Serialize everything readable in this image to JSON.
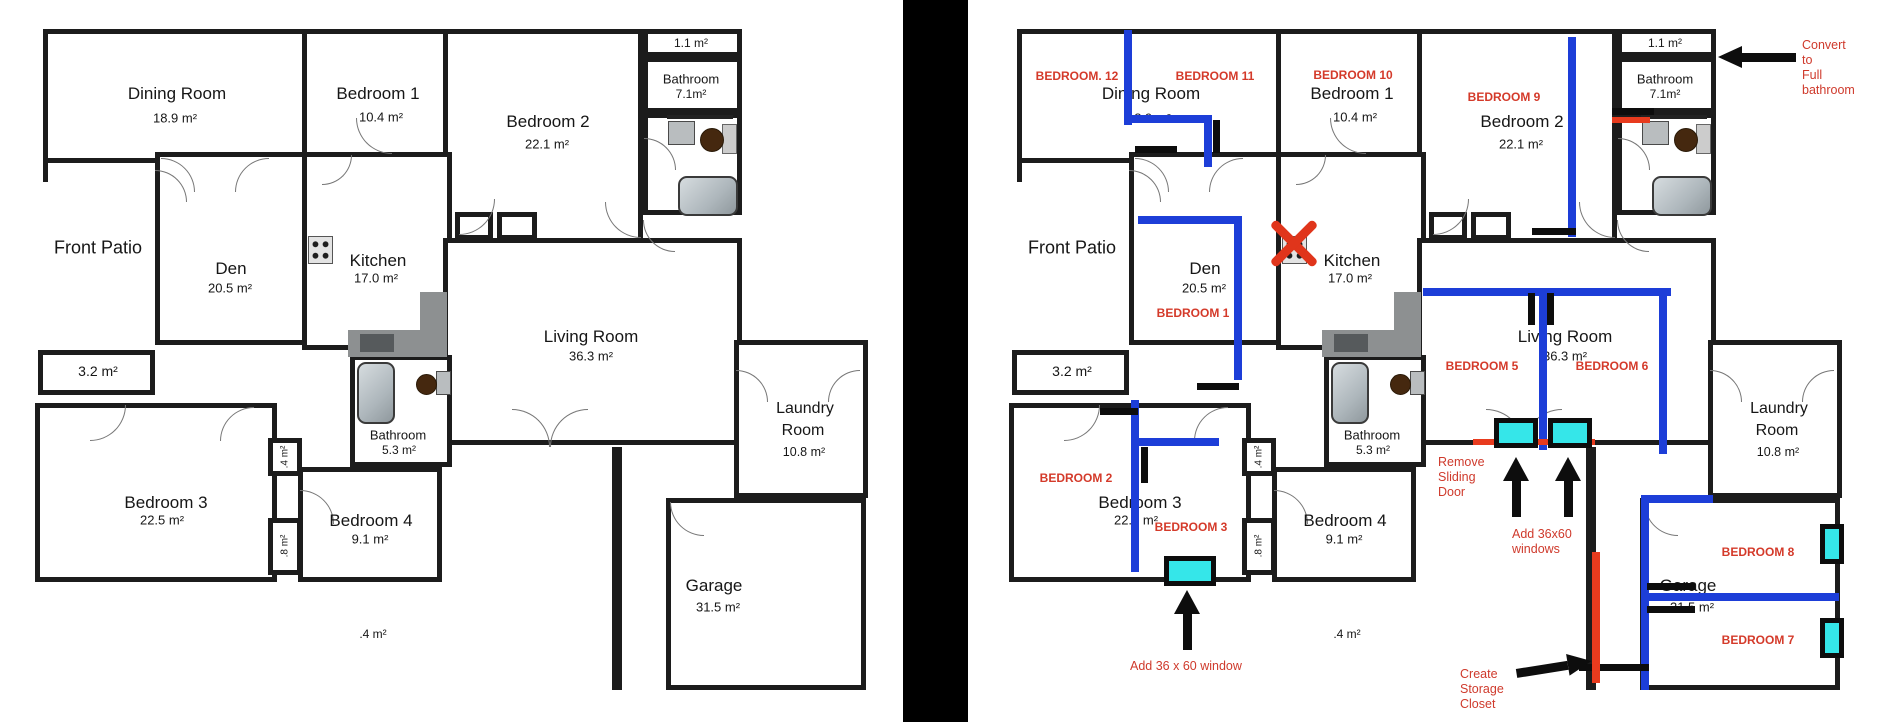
{
  "colors": {
    "wall": "#1c1c1c",
    "new_wall_blue": "#1d3ed8",
    "annotation_red": "#d43a2a",
    "remove_red": "#e83b1e",
    "window_cyan": "#35e6e9",
    "divider": "#000000"
  },
  "base_plan": {
    "rooms": [
      {
        "id": "dining-room",
        "name": "Dining Room",
        "area": "18.9 m²",
        "box": [
          13,
          11,
          267,
          134
        ],
        "nl": [
          147,
          76
        ],
        "al": [
          145,
          100
        ]
      },
      {
        "id": "bedroom-1",
        "name": "Bedroom 1",
        "area": "10.4 m²",
        "box": [
          272,
          11,
          150,
          134
        ],
        "nl": [
          348,
          76
        ],
        "al": [
          351,
          99
        ]
      },
      {
        "id": "bedroom-2",
        "name": "Bedroom 2",
        "area": "22.1 m²",
        "box": [
          413,
          11,
          200,
          218
        ],
        "nl": [
          518,
          104
        ],
        "al": [
          517,
          126
        ]
      },
      {
        "id": "closet-top",
        "name": "",
        "area": "1.1 m²",
        "box": [
          613,
          11,
          99,
          28
        ],
        "al": [
          661,
          25
        ],
        "cls": "sm"
      },
      {
        "id": "bathroom-top",
        "name": "Bathroom",
        "area": "7.1m²",
        "box": [
          613,
          39,
          99,
          56
        ],
        "nl": [
          661,
          61
        ],
        "al": [
          661,
          76
        ],
        "cls": "sm"
      },
      {
        "id": "bathroom-top-wc",
        "name": "",
        "area": "",
        "box": [
          613,
          95,
          99,
          102
        ]
      },
      {
        "id": "den",
        "name": "Den",
        "area": "20.5 m²",
        "box": [
          125,
          134,
          155,
          193
        ],
        "nl": [
          201,
          251
        ],
        "al": [
          200,
          270
        ]
      },
      {
        "id": "kitchen",
        "name": "Kitchen",
        "area": "17.0 m²",
        "box": [
          272,
          134,
          150,
          198
        ],
        "nl": [
          348,
          243
        ],
        "al": [
          346,
          260
        ]
      },
      {
        "id": "living-room",
        "name": "Living Room",
        "area": "36.3 m²",
        "box": [
          413,
          220,
          299,
          207
        ],
        "nl": [
          561,
          319
        ],
        "al": [
          561,
          338
        ]
      },
      {
        "id": "closet-32",
        "name": "",
        "area": "3.2 m²",
        "box": [
          8,
          332,
          117,
          45
        ],
        "al": [
          68,
          353
        ],
        "cls": "md"
      },
      {
        "id": "bedroom-3",
        "name": "Bedroom 3",
        "area": "22.5 m²",
        "box": [
          5,
          385,
          242,
          179
        ],
        "nl": [
          136,
          485
        ],
        "al": [
          132,
          502
        ]
      },
      {
        "id": "closet-4",
        "name": "",
        "area": ".4 m²",
        "box": [
          238,
          420,
          34,
          38
        ],
        "al": [
          255,
          439
        ],
        "cls": "xs",
        "vertical": true
      },
      {
        "id": "closet-8",
        "name": "",
        "area": ".8 m²",
        "box": [
          238,
          500,
          34,
          57
        ],
        "al": [
          255,
          528
        ],
        "cls": "xs",
        "vertical": true
      },
      {
        "id": "bedroom-4",
        "name": "Bedroom 4",
        "area": "9.1 m²",
        "box": [
          268,
          449,
          144,
          115
        ],
        "nl": [
          341,
          503
        ],
        "al": [
          340,
          521
        ]
      },
      {
        "id": "bathroom-53",
        "name": "Bathroom",
        "area": "5.3 m²",
        "box": [
          320,
          337,
          102,
          112
        ],
        "nl": [
          368,
          417
        ],
        "al": [
          369,
          432
        ],
        "cls": "sm"
      },
      {
        "id": "bedroom2-closet-a",
        "name": "",
        "area": "",
        "box": [
          425,
          194,
          38,
          28
        ]
      },
      {
        "id": "bedroom2-closet-b",
        "name": "",
        "area": "",
        "box": [
          467,
          194,
          40,
          28
        ]
      },
      {
        "id": "laundry-room",
        "name": "Laundry",
        "name2": "Room",
        "area": "10.8 m²",
        "box": [
          704,
          322,
          134,
          158
        ],
        "nl": [
          775,
          391
        ],
        "nl2": [
          773,
          413
        ],
        "al": [
          774,
          434
        ],
        "cls": "md2"
      },
      {
        "id": "garage",
        "name": "Garage",
        "area": "31.5 m²",
        "box": [
          636,
          480,
          200,
          192
        ],
        "nl": [
          684,
          568
        ],
        "al": [
          688,
          589
        ]
      }
    ],
    "extra_walls": [
      [
        582,
        429,
        10,
        243
      ],
      [
        13,
        134,
        5,
        30
      ]
    ],
    "outside_texts": [
      {
        "id": "front-patio",
        "text": "Front Patio",
        "x": 68,
        "y": 230,
        "size": 18
      },
      {
        "id": "walkway-area",
        "text": ".4 m²",
        "x": 343,
        "y": 616,
        "size": 12
      }
    ],
    "fixtures": {
      "stove": [
        278,
        218,
        23,
        26
      ],
      "counter_h": [
        318,
        312,
        99,
        27
      ],
      "counter_v": [
        390,
        274,
        27,
        65
      ],
      "counter_sink": [
        330,
        316,
        34,
        18
      ],
      "bath_top_counter": [
        637,
        97,
        66,
        4
      ],
      "bath_top_sink": [
        638,
        103,
        25,
        22
      ],
      "bath_top_toilet": [
        670,
        110,
        22,
        22
      ],
      "bath_top_tank": [
        692,
        106,
        13,
        28
      ],
      "bath_top_tub": [
        648,
        158,
        56,
        36
      ],
      "bath53_tub": [
        327,
        344,
        34,
        58
      ],
      "bath53_toilet": [
        386,
        356,
        19,
        19
      ],
      "bath53_sink": [
        406,
        353,
        13,
        22
      ]
    },
    "arcs": [
      [
        131,
        140,
        34,
        "tr"
      ],
      [
        205,
        140,
        34,
        "tl"
      ],
      [
        326,
        100,
        36,
        "bl"
      ],
      [
        429,
        181,
        36,
        "br"
      ],
      [
        575,
        184,
        36,
        "bl"
      ],
      [
        614,
        120,
        32,
        "tr"
      ],
      [
        60,
        387,
        36,
        "br"
      ],
      [
        190,
        389,
        34,
        "tl"
      ],
      [
        270,
        472,
        34,
        "tr"
      ],
      [
        706,
        352,
        32,
        "tr"
      ],
      [
        798,
        352,
        32,
        "tl"
      ],
      [
        640,
        484,
        34,
        "bl"
      ],
      [
        482,
        391,
        38,
        "tr"
      ],
      [
        520,
        391,
        38,
        "tl"
      ],
      [
        613,
        202,
        32,
        "bl"
      ],
      [
        292,
        137,
        30,
        "br"
      ],
      [
        125,
        152,
        32,
        "tr"
      ]
    ]
  },
  "annotations": {
    "red_labels": [
      {
        "text": "BEDROOM. 12",
        "x": 73,
        "y": 58
      },
      {
        "text": "BEDROOM 11",
        "x": 211,
        "y": 58
      },
      {
        "text": "BEDROOM 10",
        "x": 349,
        "y": 57
      },
      {
        "text": "BEDROOM 9",
        "x": 500,
        "y": 79
      },
      {
        "text": "BEDROOM 1",
        "x": 189,
        "y": 295
      },
      {
        "text": "BEDROOM 2",
        "x": 72,
        "y": 460
      },
      {
        "text": "BEDROOM 3",
        "x": 187,
        "y": 509
      },
      {
        "text": "BEDROOM 5",
        "x": 478,
        "y": 348
      },
      {
        "text": "BEDROOM 6",
        "x": 608,
        "y": 348
      },
      {
        "text": "BEDROOM 8",
        "x": 754,
        "y": 534
      },
      {
        "text": "BEDROOM 7",
        "x": 754,
        "y": 622
      }
    ],
    "notes": [
      {
        "id": "convert-full-bathroom",
        "lines": [
          "Convert to",
          "Full",
          "bathroom"
        ],
        "x": 798,
        "y": 20
      },
      {
        "id": "remove-sliding-door",
        "lines": [
          "Remove",
          "Sliding",
          "Door"
        ],
        "x": 434,
        "y": 437
      },
      {
        "id": "add-36x60-windows",
        "lines": [
          "Add 36x60",
          "windows"
        ],
        "x": 508,
        "y": 509
      },
      {
        "id": "add-36x60-window",
        "lines": [
          "Add 36 x 60 window"
        ],
        "x": 126,
        "y": 641
      },
      {
        "id": "create-storage-closet",
        "lines": [
          "Create",
          "Storage",
          "Closet"
        ],
        "x": 456,
        "y": 649
      }
    ],
    "blue_walls": [
      [
        120,
        12,
        8,
        95
      ],
      [
        124,
        97,
        80,
        8
      ],
      [
        200,
        97,
        8,
        52
      ],
      [
        134,
        198,
        104,
        8
      ],
      [
        230,
        198,
        8,
        164
      ],
      [
        564,
        19,
        8,
        200
      ],
      [
        419,
        270,
        248,
        8
      ],
      [
        535,
        270,
        8,
        162
      ],
      [
        655,
        270,
        8,
        166
      ],
      [
        127,
        382,
        8,
        172
      ],
      [
        127,
        420,
        88,
        8
      ],
      [
        637,
        477,
        8,
        195
      ],
      [
        637,
        477,
        72,
        8
      ],
      [
        637,
        575,
        198,
        8
      ]
    ],
    "black_marks": [
      [
        131,
        128,
        42,
        7
      ],
      [
        209,
        102,
        7,
        33
      ],
      [
        193,
        365,
        42,
        7
      ],
      [
        96,
        390,
        38,
        7
      ],
      [
        137,
        429,
        7,
        36
      ],
      [
        528,
        210,
        44,
        7
      ],
      [
        524,
        275,
        7,
        32
      ],
      [
        543,
        275,
        7,
        32
      ],
      [
        608,
        90,
        42,
        7
      ],
      [
        643,
        565,
        48,
        7
      ],
      [
        643,
        588,
        48,
        7
      ],
      [
        575,
        646,
        70,
        7
      ]
    ],
    "red_marks": [
      [
        469,
        421,
        122,
        6
      ],
      [
        588,
        534,
        8,
        131
      ],
      [
        608,
        99,
        38,
        6
      ]
    ],
    "windows": [
      [
        490,
        400,
        44,
        30
      ],
      [
        544,
        400,
        44,
        30
      ],
      [
        160,
        538,
        52,
        30
      ],
      [
        816,
        506,
        24,
        40
      ],
      [
        816,
        600,
        24,
        40
      ]
    ],
    "arrows": [
      {
        "dir": "up",
        "x": 512,
        "y": 439,
        "len": 60
      },
      {
        "dir": "up",
        "x": 564,
        "y": 439,
        "len": 60
      },
      {
        "dir": "up",
        "x": 183,
        "y": 572,
        "len": 60
      },
      {
        "dir": "left",
        "x": 714,
        "y": 39,
        "len": 78
      },
      {
        "dir": "right",
        "x": 512,
        "y": 649,
        "len": 76,
        "rot": -9
      }
    ],
    "x_marker": {
      "x": 267,
      "y": 202,
      "size": 46
    }
  }
}
